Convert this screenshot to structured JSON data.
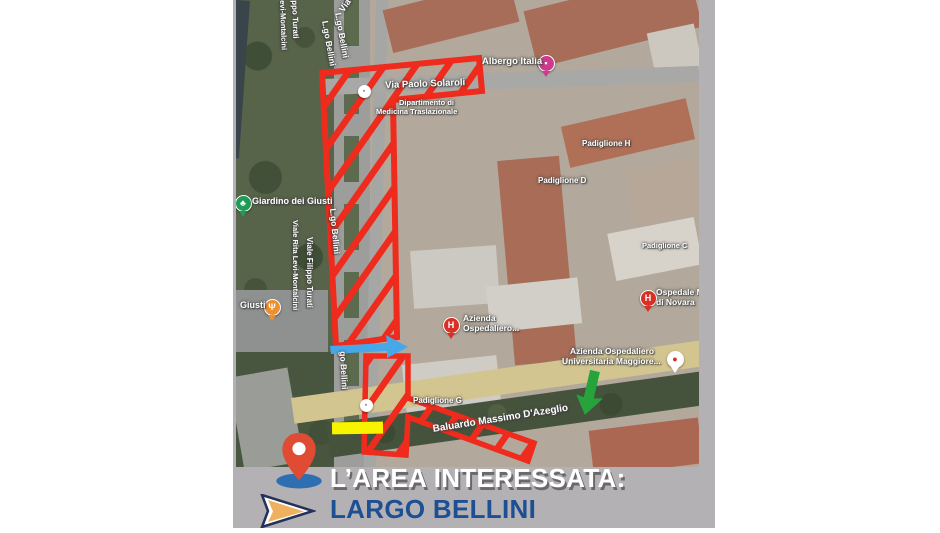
{
  "colors": {
    "panel_gray": "#b4b1b5",
    "overlay_red": "#ee2b1c",
    "arrow_blue": "#47a7e8",
    "arrow_green": "#27a33c",
    "highlight_yellow": "#f8f400",
    "pin_red": "#e04b33",
    "pin_base_blue": "#2e6fb2",
    "cursor_fill": "#efb160",
    "cursor_outline": "#24315a",
    "title_white": "#ffffff",
    "title_blue": "#1c4f94",
    "hospital_red": "#d93025",
    "hotel_pink": "#cf3a8e",
    "park_green": "#1e9b55",
    "restaurant_orange": "#ef8f2e"
  },
  "map": {
    "labels": [
      {
        "t": "Via",
        "x": 101,
        "y": 8,
        "s": 9,
        "r": -55
      },
      {
        "t": "ppo Turati",
        "x": 63,
        "y": 0,
        "s": 8,
        "r": 88
      },
      {
        "t": "evi-Montalcini",
        "x": 51,
        "y": 0,
        "s": 7.5,
        "r": 88
      },
      {
        "t": "L.go Bellini",
        "x": 107,
        "y": 12,
        "s": 8.5,
        "r": 80
      },
      {
        "t": "L.go Bellini",
        "x": 94,
        "y": 20,
        "s": 8.5,
        "r": 80
      },
      {
        "t": "Via Paolo Solaroli",
        "x": 149,
        "y": 80,
        "s": 9.5,
        "r": -2,
        "b": 1
      },
      {
        "t": "Dipartimento di",
        "x": 163,
        "y": 98,
        "s": 7.5
      },
      {
        "t": "Medicina Traslazionale",
        "x": 140,
        "y": 107,
        "s": 7.5
      },
      {
        "t": "Albergo Italia",
        "x": 246,
        "y": 56,
        "s": 9.5
      },
      {
        "t": "Padiglione H",
        "x": 346,
        "y": 139,
        "s": 8
      },
      {
        "t": "Padiglione D",
        "x": 302,
        "y": 176,
        "s": 8
      },
      {
        "t": "Padiglione C",
        "x": 406,
        "y": 241,
        "s": 7.5
      },
      {
        "t": "Ospedale M",
        "x": 420,
        "y": 287,
        "s": 8.5
      },
      {
        "t": "di Novara",
        "x": 420,
        "y": 297,
        "s": 8.5
      },
      {
        "t": "Azienda",
        "x": 227,
        "y": 313,
        "s": 8.5
      },
      {
        "t": "Ospedaliero...",
        "x": 227,
        "y": 323,
        "s": 8.5
      },
      {
        "t": "Azienda Ospedaliero",
        "x": 334,
        "y": 346,
        "s": 8.5
      },
      {
        "t": "Universitaria Maggiore...",
        "x": 326,
        "y": 356,
        "s": 8.5
      },
      {
        "t": "Giardino dei Giusti",
        "x": 16,
        "y": 196,
        "s": 9
      },
      {
        "t": "Viale Filippo Turati",
        "x": 78,
        "y": 237,
        "s": 8,
        "r": 90
      },
      {
        "t": "Viale Rita Levi-Montalcini",
        "x": 64,
        "y": 220,
        "s": 7.5,
        "r": 90
      },
      {
        "t": "L.go Bellini",
        "x": 102,
        "y": 208,
        "s": 8.5,
        "r": 85
      },
      {
        "t": "go Bellini",
        "x": 112,
        "y": 351,
        "s": 8.5,
        "r": 87
      },
      {
        "t": "Giusti",
        "x": 4,
        "y": 300,
        "s": 9
      },
      {
        "t": "Padiglione G",
        "x": 177,
        "y": 396,
        "s": 8
      },
      {
        "t": "Baluardo Massimo D'Azeglio",
        "x": 196,
        "y": 424,
        "s": 10,
        "r": -9,
        "b": 1
      }
    ],
    "markers": [
      {
        "n": "hotel-marker",
        "x": 309,
        "y": 62,
        "r": 7.5,
        "c": "#cf3a8e",
        "g": "▪",
        "gc": "#ffffff",
        "tail": 1
      },
      {
        "n": "park-marker",
        "x": 6,
        "y": 202,
        "r": 7.5,
        "c": "#1e9b55",
        "g": "♣",
        "gc": "#ffffff",
        "tail": 1
      },
      {
        "n": "restaurant-marker",
        "x": 35,
        "y": 306,
        "r": 7.5,
        "c": "#ef8f2e",
        "g": "Ψ",
        "gc": "#ffffff",
        "tail": 1
      },
      {
        "n": "hospital-marker",
        "x": 214,
        "y": 324,
        "r": 7.5,
        "c": "#d93025",
        "g": "H",
        "gc": "#ffffff",
        "tail": 1
      },
      {
        "n": "hospital-marker",
        "x": 411,
        "y": 297,
        "r": 7.5,
        "c": "#d93025",
        "g": "H",
        "gc": "#ffffff",
        "tail": 1
      },
      {
        "n": "hospital-pin-marker",
        "x": 438,
        "y": 358,
        "r": 7.5,
        "c": "#ffffff",
        "g": "●",
        "gc": "#d93025",
        "tail": 1
      },
      {
        "n": "parking-icon",
        "x": 127,
        "y": 90,
        "r": 5.5,
        "c": "#ffffff",
        "g": "▪",
        "gc": "#8a8a8a"
      },
      {
        "n": "parking-icon",
        "x": 129,
        "y": 404,
        "r": 5.5,
        "c": "#ffffff",
        "g": "▪",
        "gc": "#8a8a8a"
      }
    ]
  },
  "caption": {
    "line1": "L’AREA INTERESSATA:",
    "line2": "LARGO BELLINI"
  }
}
